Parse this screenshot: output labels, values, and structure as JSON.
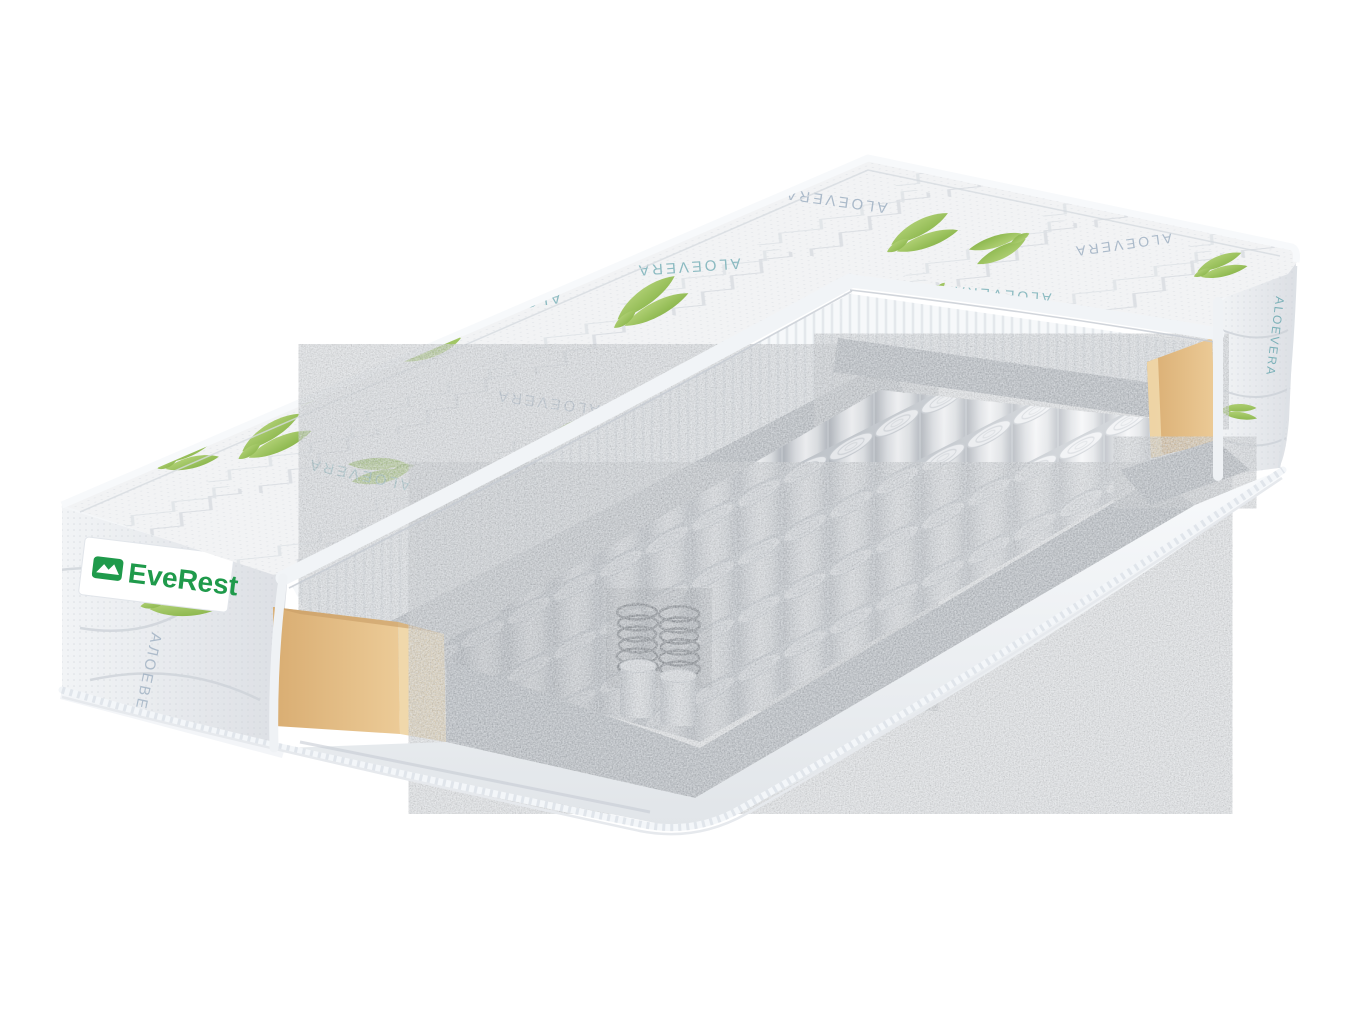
{
  "image": {
    "type": "product-photo",
    "background": "#ffffff",
    "subject": "mattress-cutaway-cross-section"
  },
  "brand": {
    "name": "EveRest",
    "text_color": "#1f9a4b",
    "icon": "bed-mountain-icon",
    "icon_color": "#1f9a4b",
    "label_bg": "#ffffff"
  },
  "fabric_prints": {
    "latin": "ALOEVERA",
    "cyrillic": "АЛОЕВЕРА",
    "text_color_gray": "#93a7bb",
    "text_color_teal": "#6aa8b0",
    "leaf_light": "#bdd983",
    "leaf_dark": "#7fae3f"
  },
  "materials": {
    "cover_fabric": "#ebedef",
    "quilt_line": "#c3c9d1",
    "foam_white": "#f6f8fa",
    "felt_gray": "#aab0b7",
    "spring_fabric": "#eceef0",
    "steel_wire": "#575c63",
    "edge_foam_tan_dark": "#d9ad72",
    "edge_foam_tan_light": "#eccb97",
    "base_rim": "#f0f3f6",
    "piping": "#f3f6f9"
  }
}
